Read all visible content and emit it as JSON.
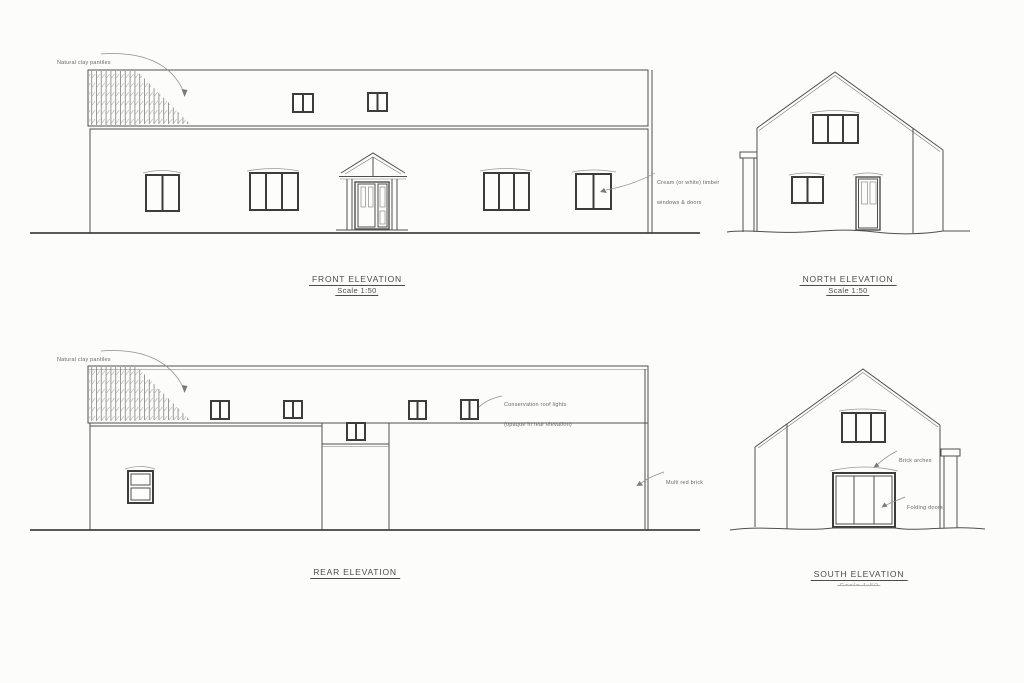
{
  "sheet": {
    "background_color": "#fcfcfb",
    "line_color": "#4f4f4f",
    "text_color": "#4a4a4a"
  },
  "panels": {
    "front": {
      "title": "FRONT ELEVATION",
      "scale": "Scale 1:50",
      "annotations": {
        "pantiles": "Natural clay pantiles",
        "joinery_line1": "Cream (or white) timber",
        "joinery_line2": "windows & doors"
      }
    },
    "north": {
      "title": "NORTH ELEVATION",
      "scale": "Scale 1:50"
    },
    "rear": {
      "title": "REAR ELEVATION",
      "annotations": {
        "pantiles": "Natural clay pantiles",
        "rooflights_line1": "Conservation roof lights",
        "rooflights_line2": "(opaque in rear elevation)",
        "brick": "Multi red brick"
      }
    },
    "south": {
      "title": "SOUTH ELEVATION",
      "scale": "Scale 1:50",
      "annotations": {
        "arches": "Brick arches",
        "doors": "Folding doors"
      }
    }
  }
}
